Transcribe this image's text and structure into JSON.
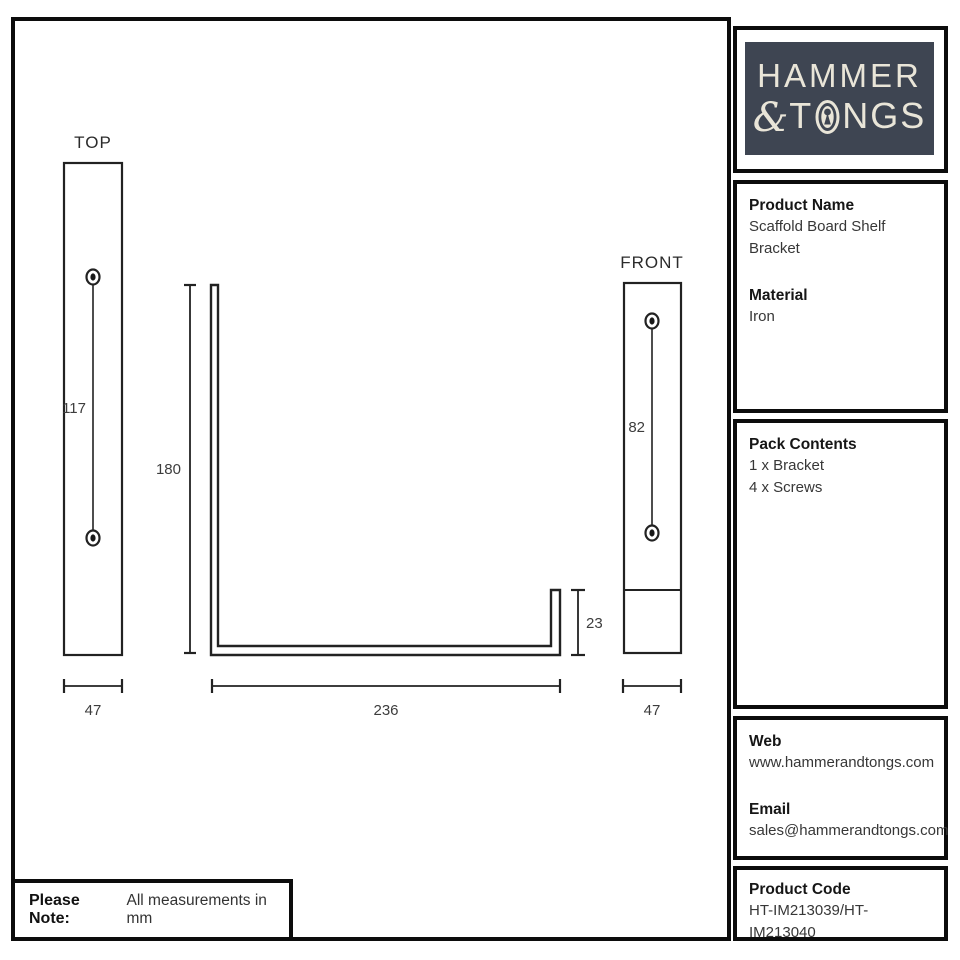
{
  "drawing": {
    "top_view": {
      "label": "TOP",
      "hole_spacing_mm": "117",
      "width_mm": "47"
    },
    "side_view": {
      "height_mm": "180",
      "depth_mm": "236",
      "lip_mm": "23"
    },
    "front_view": {
      "label": "FRONT",
      "hole_spacing_mm": "82",
      "width_mm": "47"
    },
    "note": {
      "label": "Please Note:",
      "text": "All measurements in mm"
    }
  },
  "sidebar": {
    "logo": {
      "line1": "HAMMER",
      "ampersand": "&",
      "line2_t": "T",
      "line2_ngs": "NGS",
      "icon": "keyhole-icon",
      "bg_color": "#3e4552",
      "text_color": "#e9e5d8"
    },
    "product": {
      "name_heading": "Product Name",
      "name": "Scaffold Board Shelf Bracket",
      "material_heading": "Material",
      "material": "Iron"
    },
    "pack": {
      "heading": "Pack Contents",
      "items": [
        "1 x Bracket",
        "4 x Screws"
      ]
    },
    "contact": {
      "web_heading": "Web",
      "web": "www.hammerandtongs.com",
      "email_heading": "Email",
      "email": "sales@hammerandtongs.com"
    },
    "code": {
      "heading": "Product Code",
      "value": "HT-IM213039/HT-IM213040"
    }
  }
}
